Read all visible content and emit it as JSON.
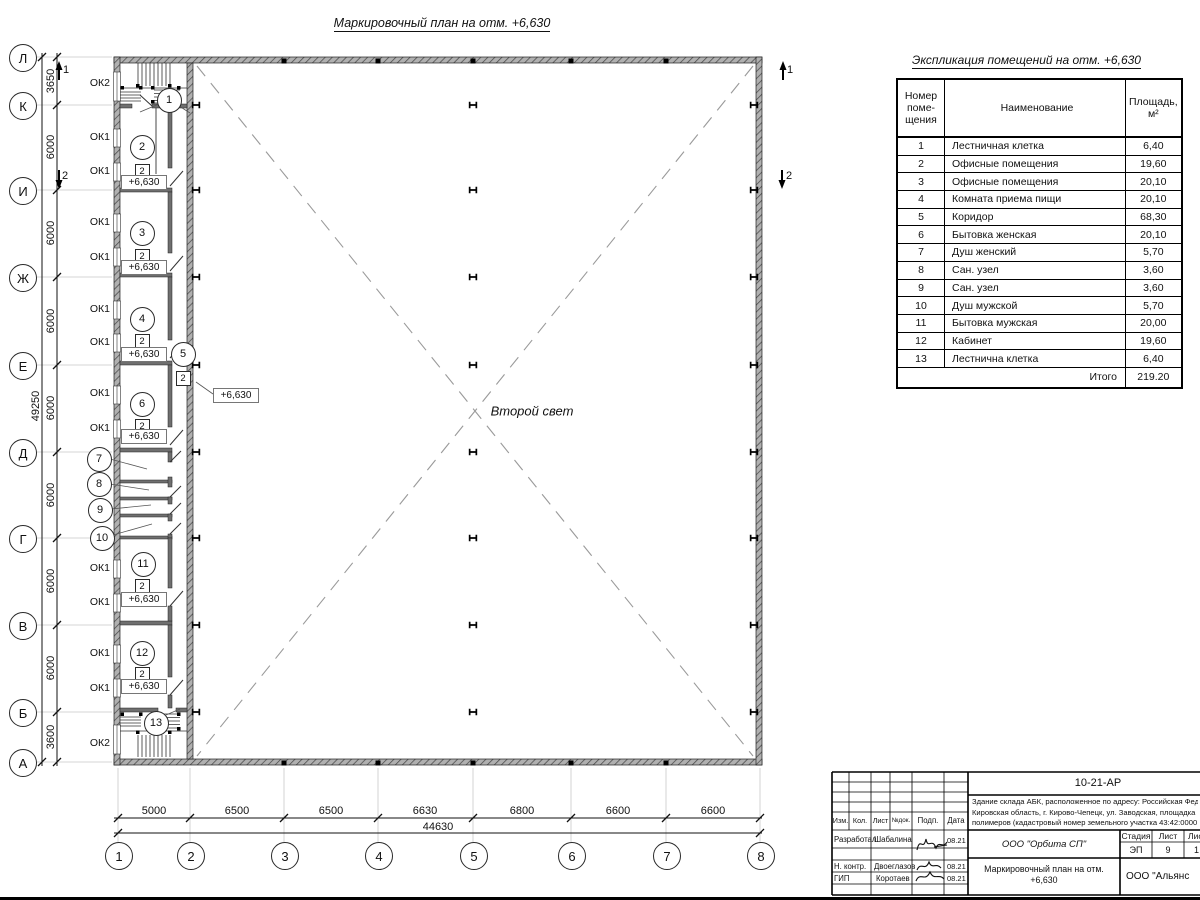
{
  "plan": {
    "title": "Маркировочный план на отм. +6,630",
    "second_light": "Второй свет",
    "elevation": "+6,630",
    "type_badge": "2",
    "row_axes": [
      "Л",
      "К",
      "И",
      "Ж",
      "Е",
      "Д",
      "Г",
      "В",
      "Б",
      "А"
    ],
    "col_axes": [
      "1",
      "2",
      "3",
      "4",
      "5",
      "6",
      "7",
      "8"
    ],
    "v_dims": [
      "3650",
      "6000",
      "6000",
      "6000",
      "6000",
      "6000",
      "6000",
      "6000",
      "3600"
    ],
    "v_total": "49250",
    "h_dims": [
      "5000",
      "6500",
      "6500",
      "6630",
      "6800",
      "6600",
      "6600"
    ],
    "h_total": "44630",
    "window_labels": [
      "ОК2",
      "ОК1",
      "ОК1",
      "ОК1",
      "ОК1",
      "ОК1",
      "ОК1",
      "ОК1",
      "ОК1",
      "ОК1",
      "ОК1",
      "ОК1",
      "ОК1",
      "ОК2"
    ],
    "rooms": [
      "1",
      "2",
      "3",
      "4",
      "5",
      "6",
      "7",
      "8",
      "9",
      "10",
      "11",
      "12",
      "13"
    ],
    "sections": [
      "1",
      "2"
    ]
  },
  "schedule": {
    "title": "Экспликация помещений на отм. +6,630",
    "header": {
      "c0": [
        "Номер",
        "поме-",
        "щения"
      ],
      "c1": "Наименование",
      "c2": [
        "Площадь,",
        "м²"
      ]
    },
    "rows": [
      [
        "1",
        "Лестничная клетка",
        "6,40"
      ],
      [
        "2",
        "Офисные помещения",
        "19,60"
      ],
      [
        "3",
        "Офисные помещения",
        "20,10"
      ],
      [
        "4",
        "Комната приема пищи",
        "20,10"
      ],
      [
        "5",
        "Коридор",
        "68,30"
      ],
      [
        "6",
        "Бытовка женская",
        "20,10"
      ],
      [
        "7",
        "Душ женский",
        "5,70"
      ],
      [
        "8",
        "Сан. узел",
        "3,60"
      ],
      [
        "9",
        "Сан. узел",
        "3,60"
      ],
      [
        "10",
        "Душ мужской",
        "5,70"
      ],
      [
        "11",
        "Бытовка мужская",
        "20,00"
      ],
      [
        "12",
        "Кабинет",
        "19,60"
      ],
      [
        "13",
        "Лестнична клетка",
        "6,40"
      ]
    ],
    "total_label": "Итого",
    "total_value": "219.20"
  },
  "titleblock": {
    "doc_number": "10-21-АР",
    "address": [
      "Здание склада АБК, расположенное по адресу: Российская Феде",
      "Кировская область, г. Кирово-Чепецк, ул. Заводская, площадка",
      "полимеров (кадастровый номер земельного участка 43:42:0000"
    ],
    "columns": [
      "Изм.",
      "Кол.",
      "Лист",
      "№док.",
      "Подп.",
      "Дата"
    ],
    "rows": [
      {
        "role": "Разработал",
        "name": "Шабалина",
        "date": "08.21"
      },
      {
        "role": "Н. контр.",
        "name": "Двоеглазов",
        "date": "08.21"
      },
      {
        "role": "ГИП",
        "name": "Коротаев",
        "date": "08.21"
      }
    ],
    "org": "ООО \"Орбита СП\"",
    "stage": {
      "headers": [
        "Стадия",
        "Лист",
        "Листов"
      ],
      "values": [
        "ЭП",
        "9",
        "1"
      ]
    },
    "sheet_title": [
      "Маркировочный план на отм.",
      "+6,630"
    ],
    "org2": "ООО \"Альянс"
  }
}
